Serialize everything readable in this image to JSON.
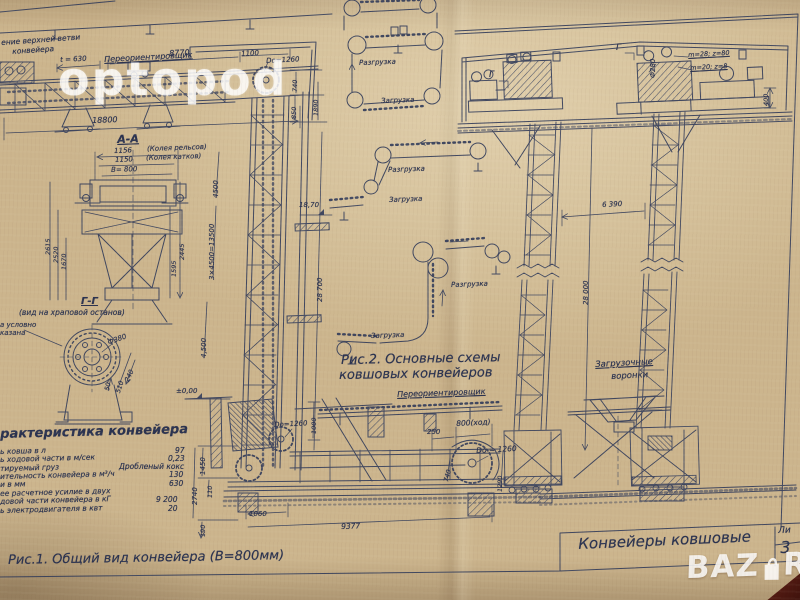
{
  "watermark": {
    "name": "optopod",
    "shop": "BAZ",
    "shop2": "R"
  },
  "colors": {
    "paper": "#ccb58d",
    "ink": "#333d5b",
    "watermark": "rgba(255,255,255,0.8)",
    "table_corner": "#4e1710"
  },
  "figure1": {
    "caption": "Рис.1. Общий  вид  конвейера   (В=800мм)",
    "note1": "ение верхней ветви",
    "note2": "конвейера",
    "reorienter": "Переориентировщик",
    "t630": "t = 630",
    "d8770": "8770",
    "d1100": "1100",
    "do1260top": "Dо=1260",
    "d18800": "18800",
    "d740": "740",
    "d850": "850",
    "d1890": "1890",
    "d4500": "4500",
    "d13500": "3×4500=13500",
    "d4500b": "4,500",
    "e1870": "18,70",
    "d28700": "28 700",
    "e000": "±0,00",
    "d1000": "1000",
    "do1260left": "Dо=1260",
    "d250": "250",
    "d800": "800(ход)",
    "do1260right": "Dо = 1260",
    "d1290": "1290",
    "d740b": "740",
    "d1060": "1060",
    "d9377": "9377",
    "d1450": "1450",
    "d2740": "2740",
    "d110": "110",
    "d190": "190"
  },
  "sectionAA": {
    "title": "А-А",
    "d1156": "1156",
    "note_rails": "(Колея рельсов)",
    "d1150": "1150",
    "note_rollers": "(Колея катков)",
    "b800": "В= 800",
    "d2615": "2615",
    "d2520": "2520",
    "d1670": "1670",
    "d1595": "1595",
    "d2445": "2445"
  },
  "sectionGG": {
    "title": "Г-Г",
    "subtitle": "(вид на храповой останов)",
    "note1": "а условно",
    "note2": "казана",
    "dia": "Ф380",
    "d240": "240",
    "d510": "510",
    "d50": "50"
  },
  "specs": {
    "title": "рактеристика  конвейера",
    "rows": [
      {
        "label": "ь ковша  в л",
        "value": "97"
      },
      {
        "label": "ь ходовой части  в м/сек",
        "value": "0,23"
      },
      {
        "label": "тируемый  груз",
        "value": "Дробленый кокс"
      },
      {
        "label": "ительность конвейера  в м³/ч",
        "value": "130"
      },
      {
        "label": "и  в мм",
        "value": "630"
      },
      {
        "label": "ее расчетное  усилие  в двух",
        "value": ""
      },
      {
        "label": "довой части конвейера  в кГ",
        "value": "9 200"
      },
      {
        "label": "ь электродвигателя  в квт",
        "value": "20"
      }
    ]
  },
  "figure2": {
    "cap1": "Рис.2. Основные  схемы",
    "cap2": "ковшовых  конвейеров",
    "unload": "Разгрузка",
    "load": "Загрузка",
    "reorienter": "Переориентировщик"
  },
  "elevation": {
    "dia280": "Ф280",
    "gear1": "m=28; z=80",
    "gear2": "m=20; z=8",
    "mark": "Г",
    "d400": "400",
    "d6390": "6 390",
    "d28000": "28 000",
    "funnel1": "Загрузочные",
    "funnel2": "воронки"
  },
  "titleblock": {
    "title": "Конвейеры  ковшовые",
    "sheet": "Ли",
    "number": "3"
  }
}
